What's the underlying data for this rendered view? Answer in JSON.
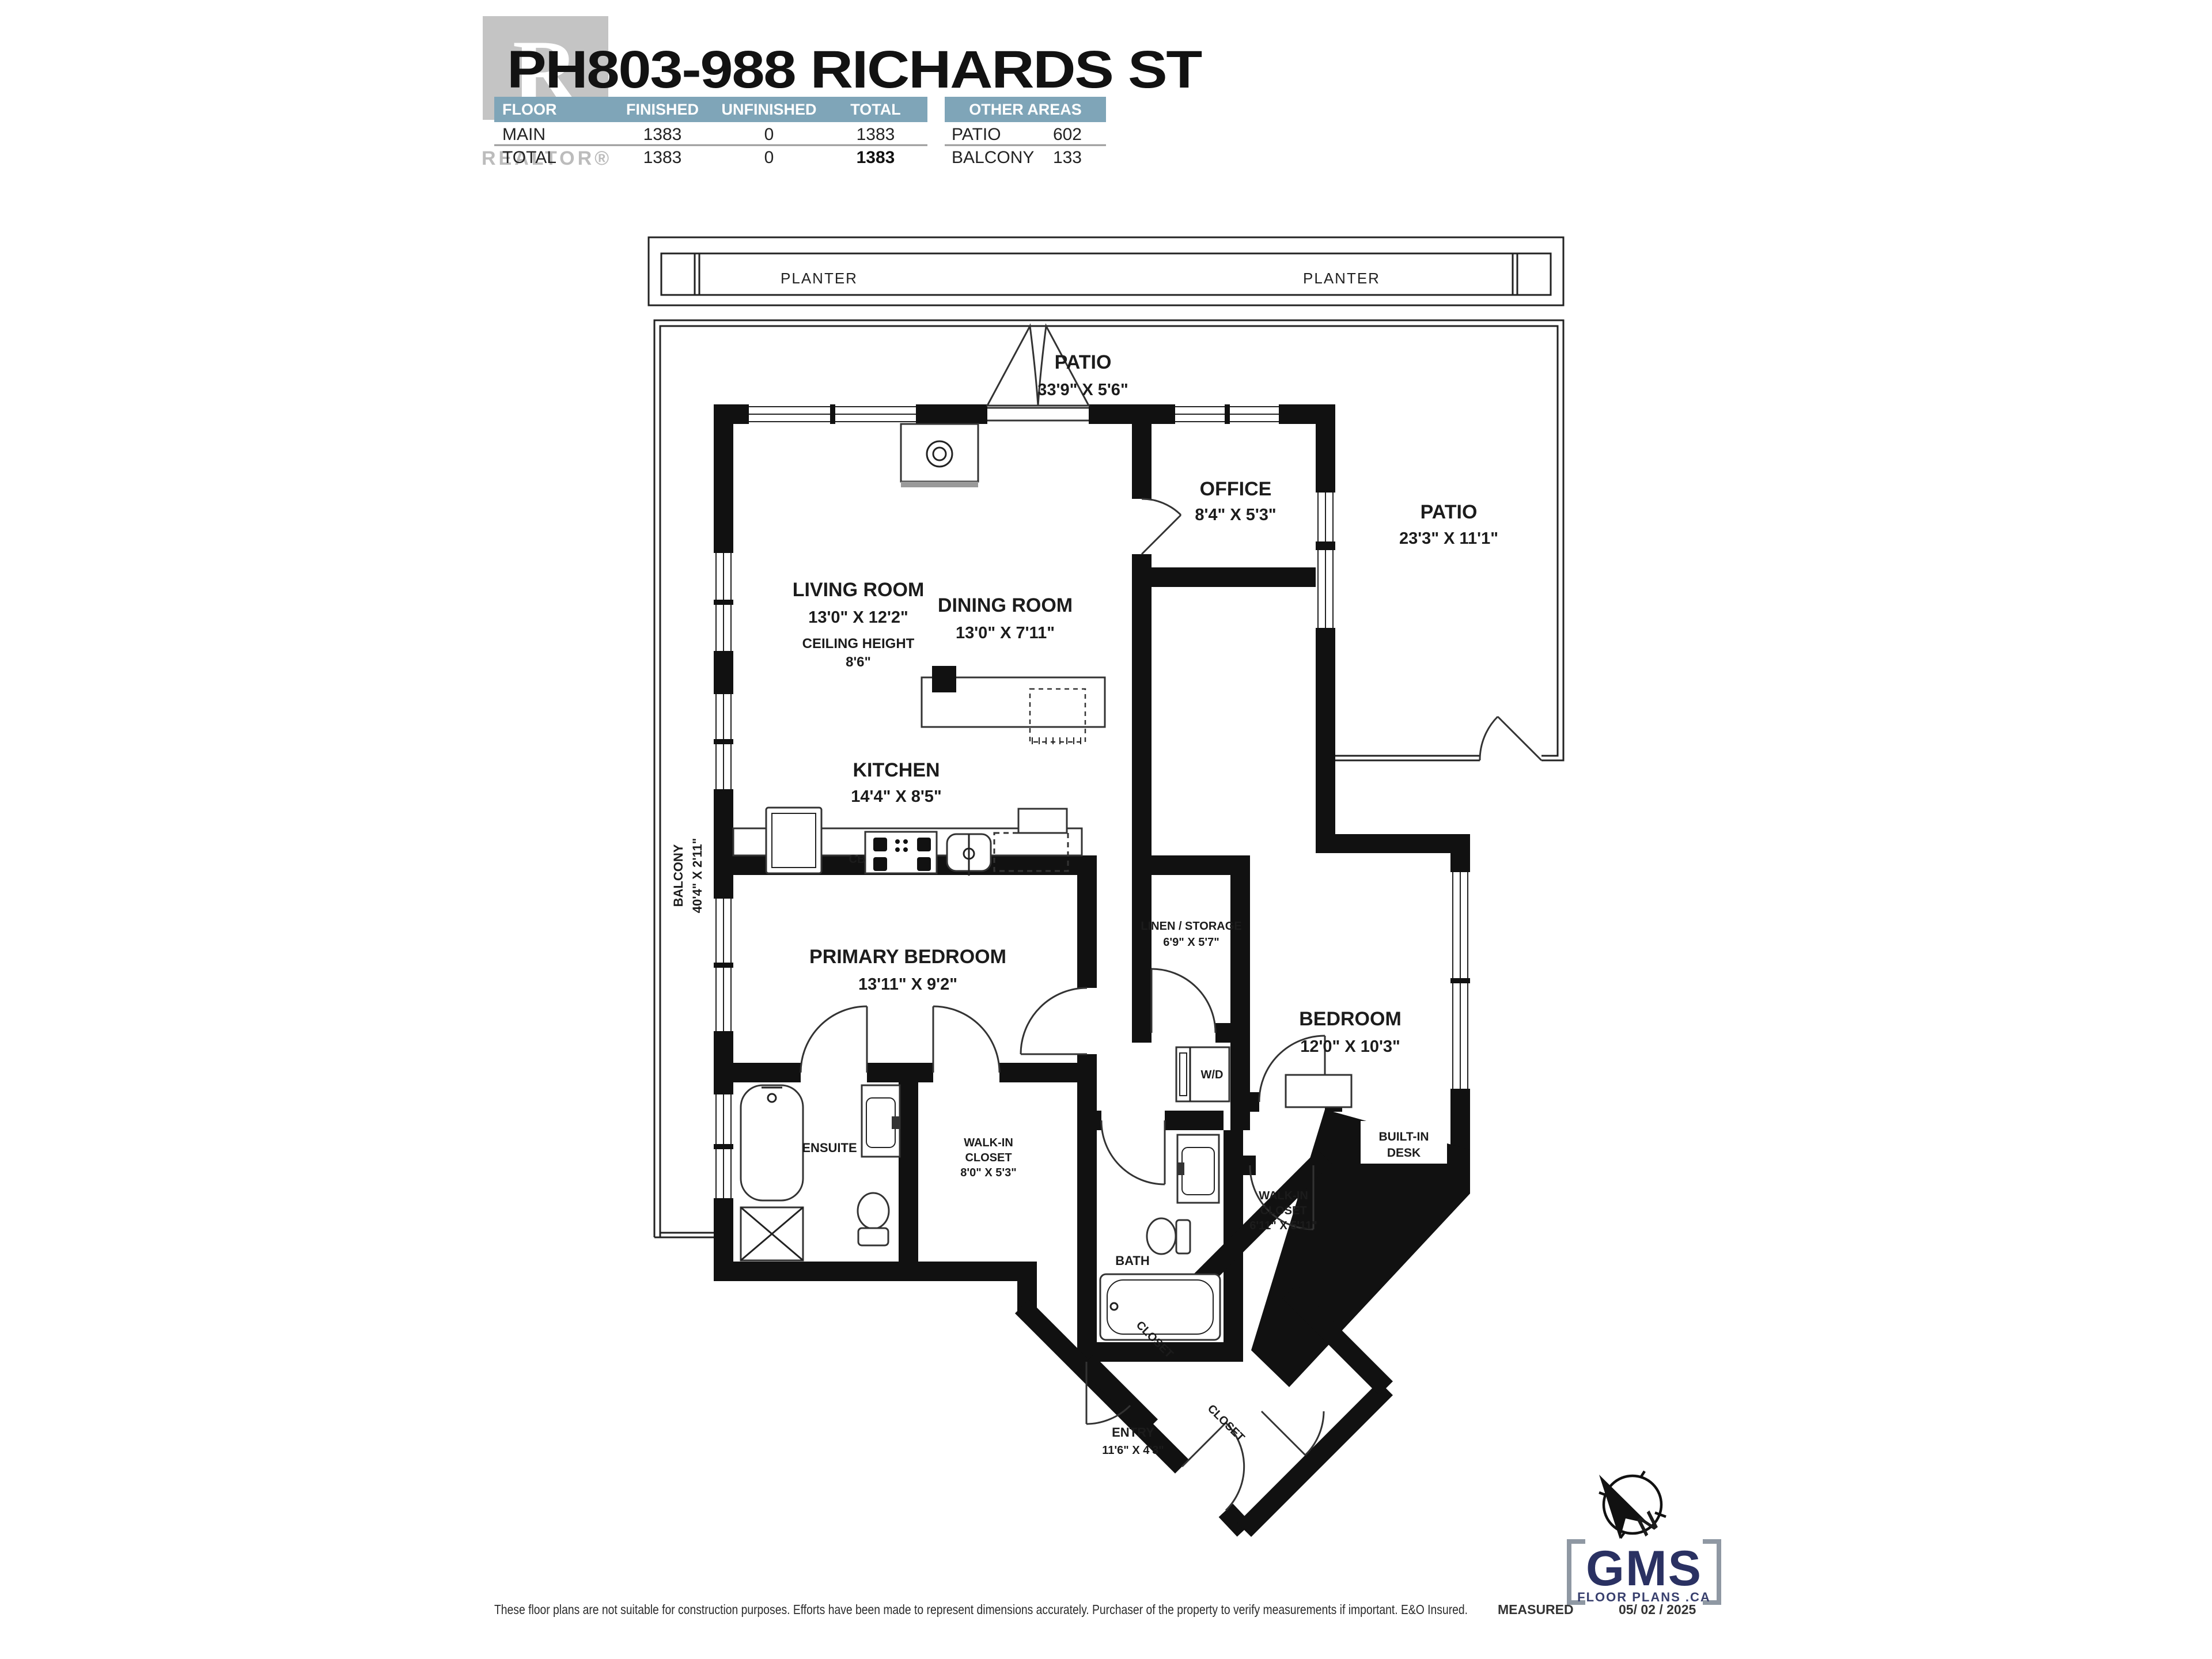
{
  "colors": {
    "wall": "#111111",
    "line": "#222222",
    "table_header": "#7FA5B8",
    "brand_navy": "#2A3162",
    "logo_grey": "#C4C4C4"
  },
  "header": {
    "title": "PH803-988 RICHARDS ST",
    "realtor_logo": {
      "letter": "R",
      "wordmark": "REALTOR®"
    },
    "area_table": {
      "columns": [
        "FLOOR",
        "FINISHED",
        "UNFINISHED",
        "TOTAL"
      ],
      "rows": [
        {
          "floor": "MAIN",
          "finished": "1383",
          "unfinished": "0",
          "total": "1383"
        },
        {
          "floor": "TOTAL",
          "finished": "1383",
          "unfinished": "0",
          "total": "1383"
        }
      ]
    },
    "other_areas": {
      "title": "OTHER AREAS",
      "rows": [
        {
          "name": "PATIO",
          "value": "602"
        },
        {
          "name": "BALCONY",
          "value": "133"
        }
      ]
    }
  },
  "plan": {
    "planter_left": "PLANTER",
    "planter_right": "PLANTER",
    "rooms": {
      "patio_top": {
        "l1": "PATIO",
        "l2": "33'9\" X 5'6\""
      },
      "living": {
        "l1": "LIVING ROOM",
        "l2": "13'0\" X 12'2\"",
        "l3": "CEILING HEIGHT",
        "l4": "8'6\""
      },
      "dining": {
        "l1": "DINING ROOM",
        "l2": "13'0\" X 7'11\""
      },
      "office": {
        "l1": "OFFICE",
        "l2": "8'4\" X 5'3\""
      },
      "patio_right": {
        "l1": "PATIO",
        "l2": "23'3\" X 11'1\""
      },
      "kitchen": {
        "l1": "KITCHEN",
        "l2": "14'4\" X 8'5\""
      },
      "balcony": {
        "l1": "BALCONY",
        "l2": "40'4\" X 2'11\""
      },
      "primary": {
        "l1": "PRIMARY BEDROOM",
        "l2": "13'11\" X 9'2\""
      },
      "ensuite": {
        "l1": "ENSUITE"
      },
      "wic1": {
        "l1": "WALK-IN",
        "l2": "CLOSET",
        "l3": "8'0\" X 5'3\""
      },
      "linen": {
        "l1": "LINEN / STORAGE",
        "l2": "6'9\" X 5'7\""
      },
      "bedroom": {
        "l1": "BEDROOM",
        "l2": "12'0\" X 10'3\""
      },
      "wd": {
        "l1": "W/D"
      },
      "bath": {
        "l1": "BATH"
      },
      "wic2": {
        "l1": "WALK-IN",
        "l2": "CLOSET",
        "l3": "6'11\" X 5'11\""
      },
      "desk": {
        "l1": "BUILT-IN",
        "l2": "DESK"
      },
      "entry": {
        "l1": "ENTRY",
        "l2": "11'6\" X 4'3\""
      },
      "closet1": {
        "l1": "CLOSET"
      },
      "closet2": {
        "l1": "CLOSET"
      },
      "cb": {
        "l1": "CB"
      }
    }
  },
  "footer": {
    "disclaimer": "These floor plans are not suitable for construction purposes. Efforts have been made to represent dimensions accurately.  Purchaser of the property to verify measurements if important.  E&O Insured.",
    "measured_label": "MEASURED",
    "measured_date": "05/ 02 / 2025",
    "brand": {
      "name": "GMS",
      "sub": "FLOOR PLANS .CA"
    },
    "compass_n": "N"
  }
}
